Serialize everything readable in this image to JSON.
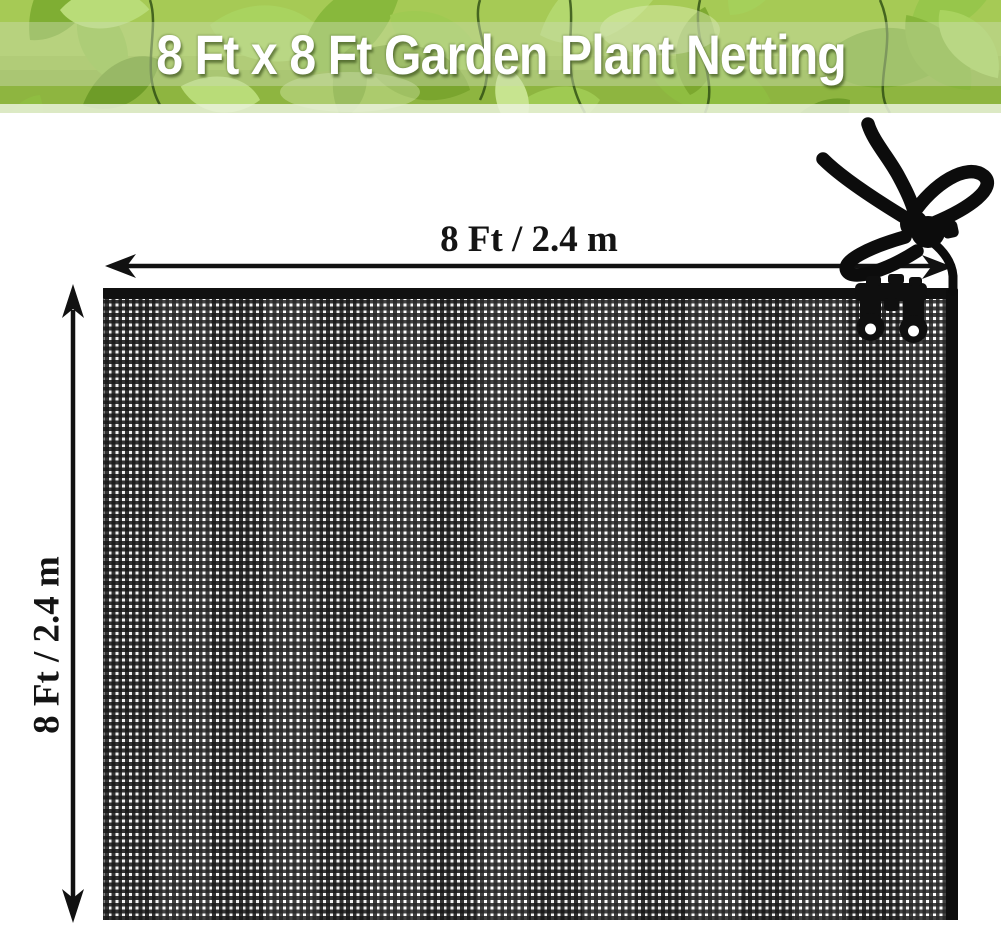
{
  "banner": {
    "title": "8 Ft x 8 Ft Garden Plant Netting",
    "title_color": "#ffffff",
    "leaf_greens": [
      "#6e9c28",
      "#88b83c",
      "#a9d35f",
      "#c7e48f"
    ],
    "band_color": "#cddcb2"
  },
  "dimensions": {
    "width_label": "8 Ft / 2.4 m",
    "height_label": "8 Ft / 2.4 m"
  },
  "product": {
    "item": "garden plant netting",
    "net_color": "black",
    "colors": {
      "mesh": "#1c1c1c",
      "binding": "#0d0d0d",
      "annotation": "#111111"
    },
    "hardware_icons": [
      "rope-tie-icon",
      "cord-lock-toggle-icon",
      "net-clips-icon"
    ]
  }
}
